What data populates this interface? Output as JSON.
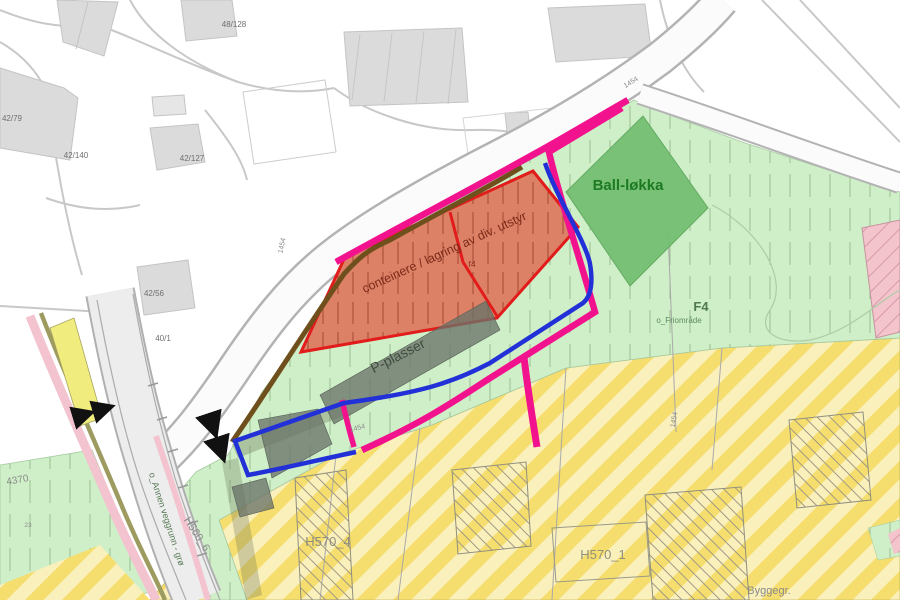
{
  "meta": {
    "kind": "zoning-plan-map",
    "description": "Utsnitt av reguleringsplan med friområde, ballplass, lagringsareal og parkering"
  },
  "labels": {
    "ball_lokka": "Ball-løkka",
    "storage": "conteinere / lagring av div. utstyr",
    "f4_small": "f4",
    "parking": "P-plasser",
    "f4_big": "F4",
    "f4_sub": "o_Friområde",
    "h570_4": "H570_4",
    "h570_1": "H570_1",
    "byggegr": "Byggegr.",
    "h560_6": "H560_6",
    "annen_veggrunn": "o_Annen veggrunn - grø",
    "code_4370": "4370",
    "code_23": "23",
    "cad_48_128": "48/128",
    "cad_42_79": "42/79",
    "cad_42_140": "42/140",
    "cad_42_127": "42/127",
    "cad_42_56": "42/56",
    "cad_40_1": "40/1",
    "n1454_a": "1454",
    "n1454_b": "1454",
    "n1454_c": "1454",
    "n1454_d": "1454"
  },
  "zone_info": [
    {
      "name": "Ball-løkka",
      "kind": "ballfield / play area",
      "color": "#74BF72"
    },
    {
      "name": "conteinere / lagring av div. utstyr",
      "kind": "container and equipment storage area",
      "color": "#DC8066",
      "outline": "#E21B1B"
    },
    {
      "name": "P-plasser",
      "kind": "parking rows",
      "color": "#6E786E"
    },
    {
      "name": "F4 o_Friområde",
      "kind": "public green / recreation area",
      "color": "#CFEFC8"
    },
    {
      "name": "H570_4",
      "kind": "hatched yellow preservation zone",
      "color": "#F6DE6E"
    },
    {
      "name": "H570_1",
      "kind": "hatched yellow preservation zone",
      "color": "#F6DE6E"
    },
    {
      "name": "H560_6",
      "kind": "road corridor zone",
      "color": "#EDEDED"
    },
    {
      "name": "o_Annen veggrunn - grø",
      "kind": "other road ground - green strip",
      "color": "#F3C3CF"
    },
    {
      "name": "Byggegr.",
      "kind": "building limit line",
      "color": "#8A8A8A"
    }
  ],
  "line_colors": {
    "plan_boundary_magenta": "#F2128E",
    "blue_outline": "#2230D8",
    "brown_edge": "#6F4F1C",
    "red_zone_outline": "#E21B1B",
    "road_casing": "#B3B3B3",
    "building_fill": "#DBDBDB"
  }
}
